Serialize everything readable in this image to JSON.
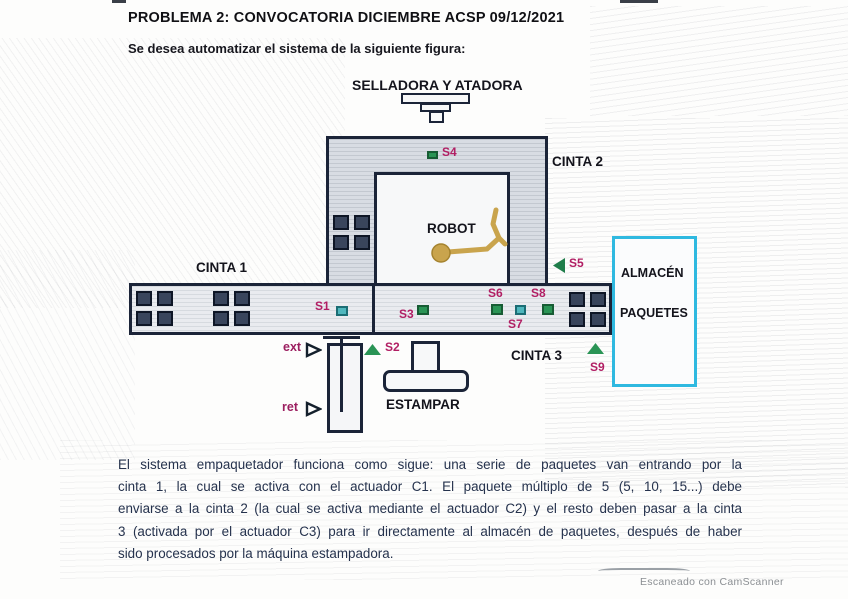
{
  "document": {
    "title": "PROBLEMA 2: CONVOCATORIA DICIEMBRE ACSP 09/12/2021",
    "intro": "Se desea automatizar el sistema de la siguiente figura:",
    "scanner_credit": "Escaneado con CamScanner"
  },
  "diagram": {
    "labels": {
      "selladora": "SELLADORA Y ATADORA",
      "cinta1": "CINTA 1",
      "cinta2": "CINTA 2",
      "cinta3": "CINTA 3",
      "robot": "ROBOT",
      "estampar": "ESTAMPAR",
      "almacen_line1": "ALMACÉN",
      "almacen_line2": "PAQUETES",
      "ext": "ext",
      "ret": "ret"
    },
    "sensors": {
      "s1": "S1",
      "s2": "S2",
      "s3": "S3",
      "s4": "S4",
      "s5": "S5",
      "s6": "S6",
      "s7": "S7",
      "s8": "S8",
      "s9": "S9"
    },
    "colors": {
      "outline": "#1b2438",
      "sensor_label": "#b11e63",
      "sensor_green": "#2a9455",
      "sensor_teal": "#4fb7bd",
      "almacen_border": "#2fb9e0",
      "robot_arm": "#c9a44d",
      "body_ink": "#25324d"
    }
  },
  "paragraph": {
    "line1": "El sistema empaquetador funciona como sigue: una serie de paquetes van entrando por la",
    "line2": "cinta 1, la cual se activa con el actuador C1.  El paquete múltiplo de 5 (5, 10, 15...) debe",
    "line3": "enviarse a la cinta 2 (la cual se activa mediante el actuador C2) y el resto deben pasar a la cinta",
    "line4": "3 (activada por el actuador C3) para ir directamente al almacén de paquetes, después de haber",
    "line5": "sido procesados por la máquina estampadora."
  }
}
